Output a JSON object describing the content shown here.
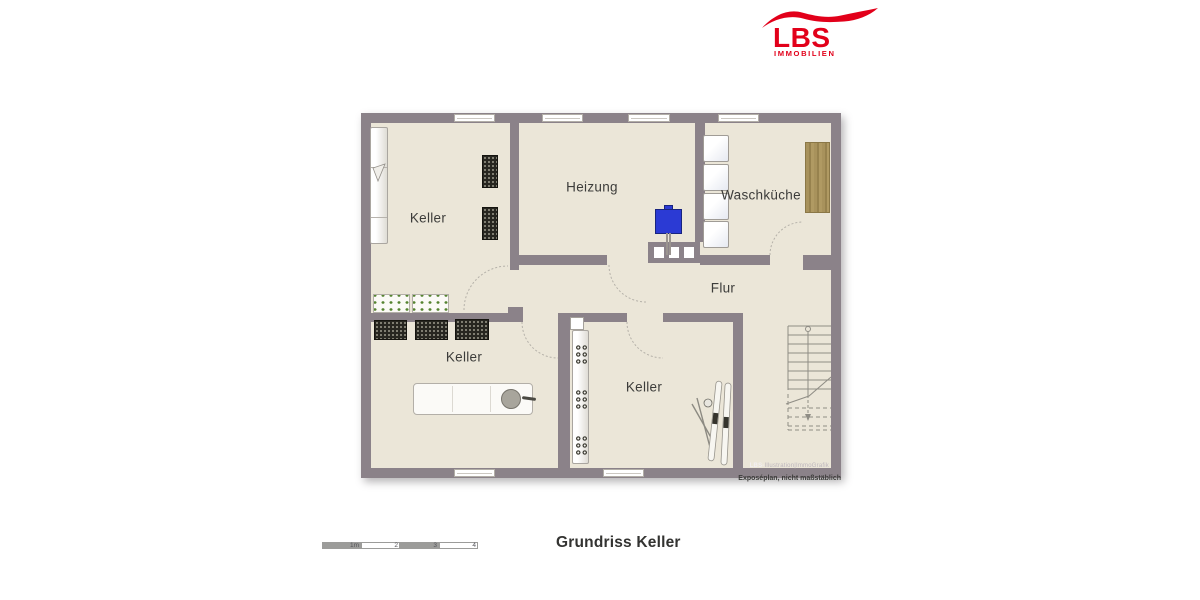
{
  "logo": {
    "text": "LBS",
    "subtext": "IMMOBILIEN",
    "color": "#e2001a"
  },
  "floorplan": {
    "rooms": [
      {
        "name": "keller-top-left",
        "label": "Keller"
      },
      {
        "name": "heizung",
        "label": "Heizung"
      },
      {
        "name": "waschkueche",
        "label": "Waschküche"
      },
      {
        "name": "flur",
        "label": "Flur"
      },
      {
        "name": "keller-bottom-left",
        "label": "Keller"
      },
      {
        "name": "keller-bottom-middle",
        "label": "Keller"
      }
    ],
    "furniture": [
      "wall-shelf",
      "wine-rack",
      "plant-crate",
      "workbench",
      "washing-machine",
      "boiler",
      "chimney-flues",
      "wood-board",
      "bottle-shelf",
      "skis",
      "staircase"
    ],
    "credit_bold": "LBS-",
    "credit_rest": "Illustration|ImmoGrafik",
    "colors": {
      "wall": "#8b8289",
      "floor": "#ebe6d8",
      "boiler_blue": "#2b3ad4",
      "wood_brown": "#a5905a"
    }
  },
  "scale_bar": {
    "labels": [
      "1m",
      "2",
      "3",
      "4"
    ]
  },
  "caption": {
    "title": "Grundriss Keller",
    "disclaimer": "Exposéplan, nicht maßstäblich"
  }
}
